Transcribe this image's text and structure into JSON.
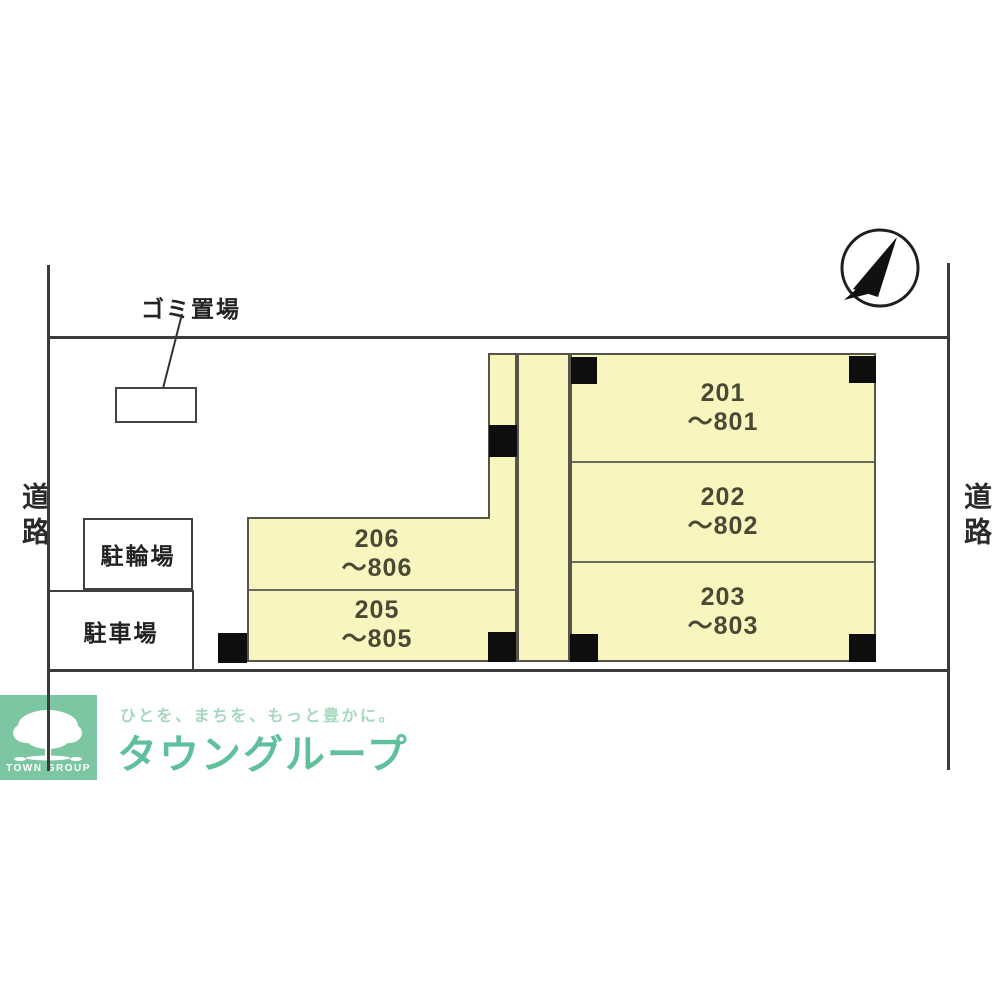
{
  "site_plan": {
    "road_label_left": "道路",
    "road_label_right": "道路",
    "garbage_label": "ゴミ置場",
    "bicycle_parking_label": "駐輪場",
    "car_parking_label": "駐車場",
    "rooms": [
      {
        "number": "201",
        "range": "～801"
      },
      {
        "number": "202",
        "range": "～802"
      },
      {
        "number": "203",
        "range": "～803"
      },
      {
        "number": "205",
        "range": "～805"
      },
      {
        "number": "206",
        "range": "～806"
      }
    ],
    "colors": {
      "room_fill": "#f8f5bf",
      "wall": "#55554a",
      "boundary": "#3b3b3b",
      "column": "#0e0e0e"
    }
  },
  "branding": {
    "logo_caption": "TOWN GROUP",
    "tagline": "ひとを、まちを、もっと豊かに。",
    "brand_name": "タウングループ",
    "colors": {
      "logo_bg": "#7cc6a1",
      "brand_text": "#5fc09b",
      "tagline_text": "#a6d8c0"
    }
  }
}
